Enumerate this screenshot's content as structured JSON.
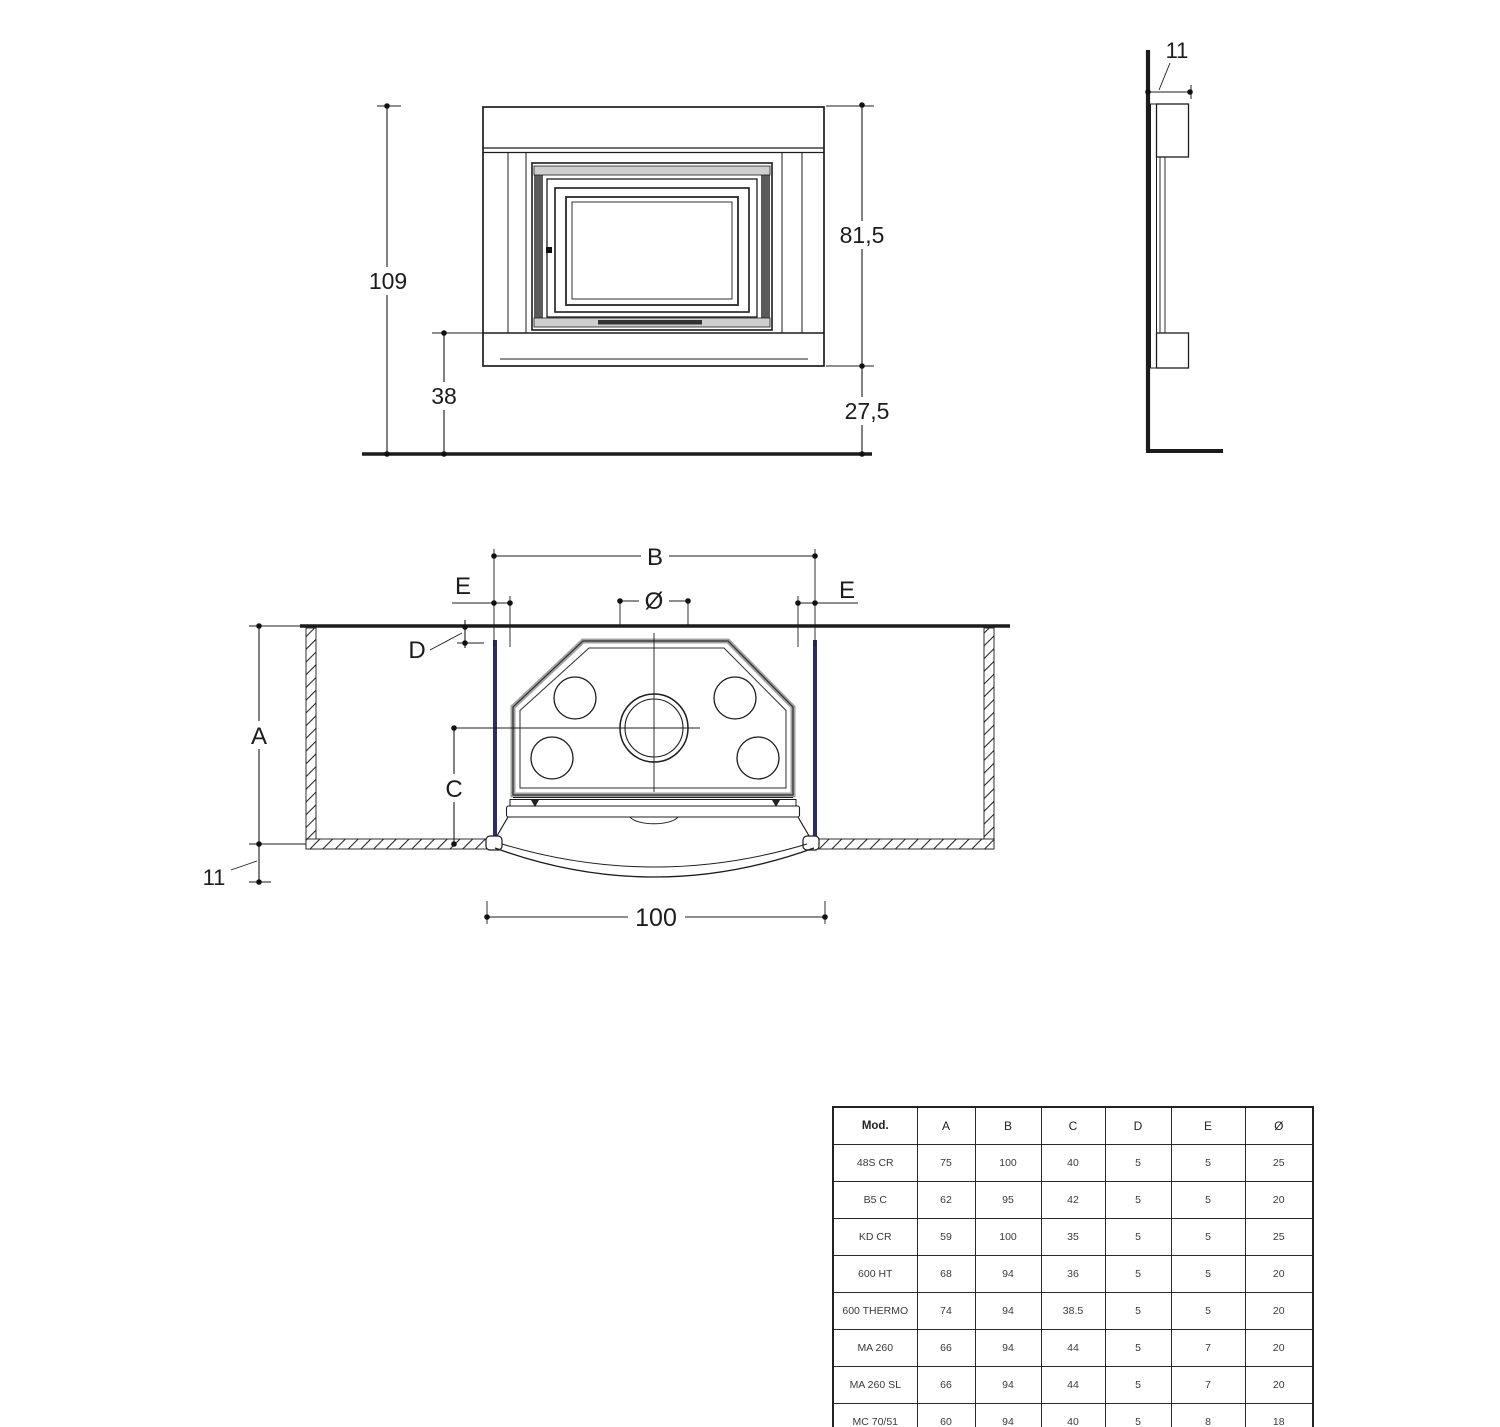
{
  "colors": {
    "line": "#1c1c1c",
    "panel_blue": "#2b2b72"
  },
  "front_view": {
    "height_total": "109",
    "plinth_height": "38",
    "opening_height": "81,5",
    "base_height": "27,5"
  },
  "side_view": {
    "depth": "11"
  },
  "plan_view": {
    "width_B": "B",
    "gap_E_left": "E",
    "gap_E_right": "E",
    "flue_diameter": "Ø",
    "gap_D": "D",
    "depth_A": "A",
    "depth_C": "C",
    "front_offset": "11",
    "overall_width": "100"
  },
  "table": {
    "headers": [
      "Mod.",
      "A",
      "B",
      "C",
      "D",
      "E",
      "Ø"
    ],
    "rows": [
      [
        "48S CR",
        "75",
        "100",
        "40",
        "5",
        "5",
        "25"
      ],
      [
        "B5 C",
        "62",
        "95",
        "42",
        "5",
        "5",
        "20"
      ],
      [
        "KD CR",
        "59",
        "100",
        "35",
        "5",
        "5",
        "25"
      ],
      [
        "600 HT",
        "68",
        "94",
        "36",
        "5",
        "5",
        "20"
      ],
      [
        "600 THERMO",
        "74",
        "94",
        "38.5",
        "5",
        "5",
        "20"
      ],
      [
        "MA 260",
        "66",
        "94",
        "44",
        "5",
        "7",
        "20"
      ],
      [
        "MA 260 SL",
        "66",
        "94",
        "44",
        "5",
        "7",
        "20"
      ],
      [
        "MC 70/51",
        "60",
        "94",
        "40",
        "5",
        "8",
        "18"
      ],
      [
        "ME 70/51",
        "72",
        "94",
        "48",
        "5",
        "6",
        "20"
      ]
    ]
  }
}
